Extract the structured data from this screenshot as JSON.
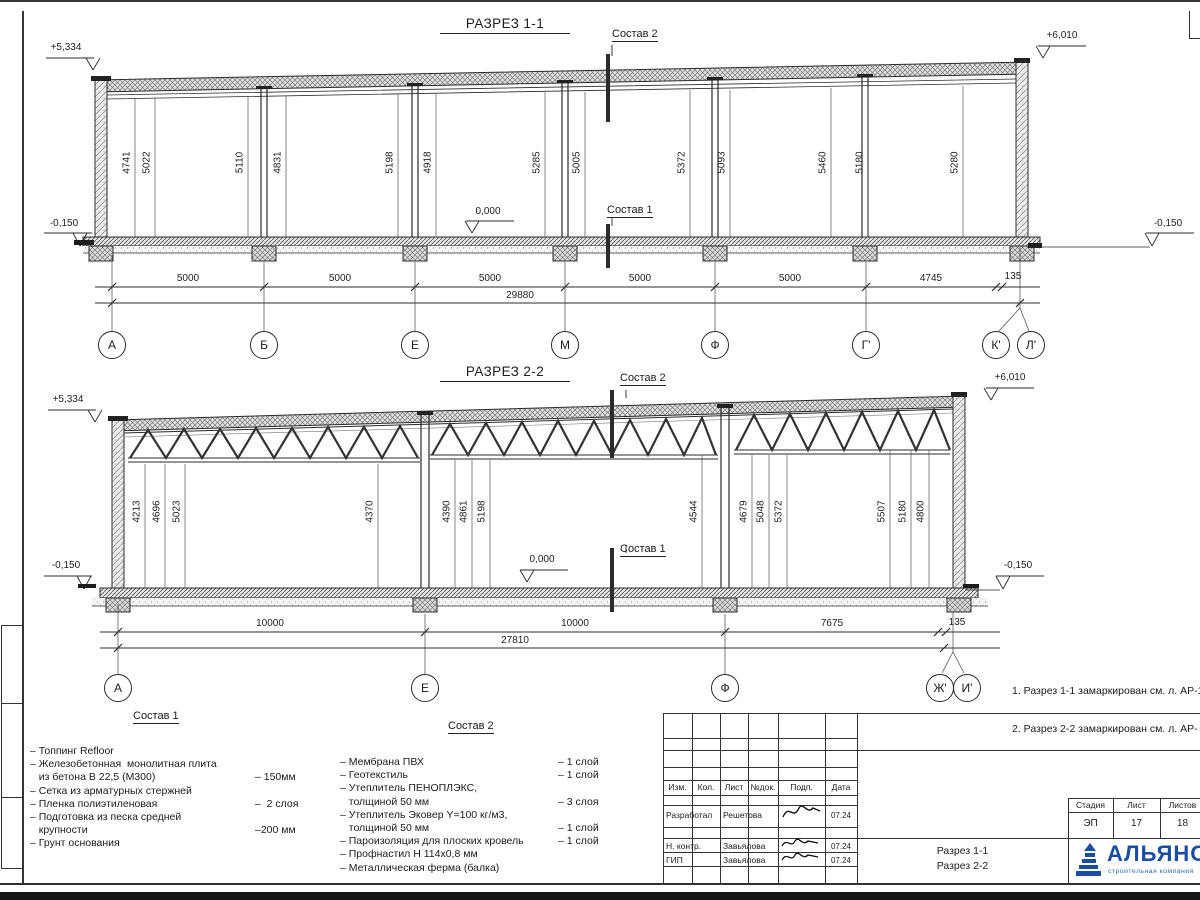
{
  "s1": {
    "title": "РАЗРЕЗ 1-1",
    "elev": {
      "tl": "+5,334",
      "tr": "+6,010",
      "zero": "0,000",
      "bl": "-0,150",
      "br": "-0,150"
    },
    "cut_top": "Состав 2",
    "cut_bottom": "Состав 1",
    "heights": [
      "4741",
      "5022",
      "5110",
      "4831",
      "5198",
      "4918",
      "5285",
      "5005",
      "5372",
      "5093",
      "5460",
      "5180",
      "5280"
    ],
    "spans": [
      "5000",
      "5000",
      "5000",
      "5000",
      "5000",
      "4745",
      "135"
    ],
    "total": "29880",
    "axes": [
      "А",
      "Б",
      "Е",
      "М",
      "Ф",
      "Г'",
      "К'",
      "Л'"
    ]
  },
  "s2": {
    "title": "РАЗРЕЗ 2-2",
    "elev": {
      "tl": "+5,334",
      "tr": "+6,010",
      "zero": "0,000",
      "bl": "-0,150",
      "br": "-0,150"
    },
    "cut_top": "Состав 2",
    "cut_bottom": "Состав 1",
    "heights": [
      "4213",
      "4696",
      "5023",
      "4370",
      "4390",
      "4861",
      "5198",
      "4544",
      "4679",
      "5048",
      "5372",
      "5507",
      "5180",
      "4800"
    ],
    "spans": [
      "10000",
      "10000",
      "7675",
      "135"
    ],
    "total": "27810",
    "axes": [
      "А",
      "Е",
      "Ф",
      "Ж'",
      "И'"
    ]
  },
  "notes": {
    "line1": "1. Разрез 1-1 замаркирован см. л. АР-15",
    "line2": "2. Разрез 2-2 замаркирован см. л. АР-"
  },
  "legend1": {
    "title": "Состав 1",
    "rows": [
      {
        "t": "– Топпинг Refloor",
        "v": ""
      },
      {
        "t": "– Железобетонная  монолитная плита",
        "v": ""
      },
      {
        "t": "   из бетона В 22,5 (М300)",
        "v": "– 150мм"
      },
      {
        "t": "– Сетка из арматурных стержней",
        "v": ""
      },
      {
        "t": "– Пленка полиэтиленовая",
        "v": "–  2 слоя"
      },
      {
        "t": "– Подготовка из песка средней",
        "v": ""
      },
      {
        "t": "   крупности",
        "v": "–200 мм"
      },
      {
        "t": "– Грунт основания",
        "v": ""
      }
    ]
  },
  "legend2": {
    "title": "Состав 2",
    "rows": [
      {
        "t": "– Мембрана ПВХ",
        "v": "– 1 слой"
      },
      {
        "t": "– Геотекстиль",
        "v": "– 1 слой"
      },
      {
        "t": "– Утеплитель ПЕНОПЛЭКС,",
        "v": ""
      },
      {
        "t": "   толщиной 50 мм",
        "v": "– 3 слоя"
      },
      {
        "t": "– Утеплитель Эковер Y=100 кг/м3,",
        "v": ""
      },
      {
        "t": "   толщиной 50 мм",
        "v": "– 1 слой"
      },
      {
        "t": "– Пароизоляция для плоских кровель",
        "v": "– 1 слой"
      },
      {
        "t": "– Профнастил Н 114х0,8 мм",
        "v": ""
      },
      {
        "t": "– Металлическая ферма (балка)",
        "v": ""
      }
    ]
  },
  "titleblock": {
    "cols": [
      "Изм.",
      "Кол.",
      "Лист",
      "№док.",
      "Подп.",
      "Дата"
    ],
    "rows": [
      {
        "role": "Разработал",
        "name": "Решетова",
        "date": "07.24"
      },
      {
        "role": "Н. контр.",
        "name": "Завьялова",
        "date": "07.24"
      },
      {
        "role": "ГИП",
        "name": "Завьялова",
        "date": "07.24"
      }
    ],
    "doc1": "Разрез 1-1",
    "doc2": "Разрез 2-2",
    "stage": {
      "h1": "Стадия",
      "h2": "Лист",
      "h3": "Листов",
      "v1": "ЭП",
      "v2": "17",
      "v3": "18"
    },
    "logo": {
      "name": "АЛЬЯНС",
      "sub": "строительная компания",
      "color": "#1b4da0"
    }
  }
}
